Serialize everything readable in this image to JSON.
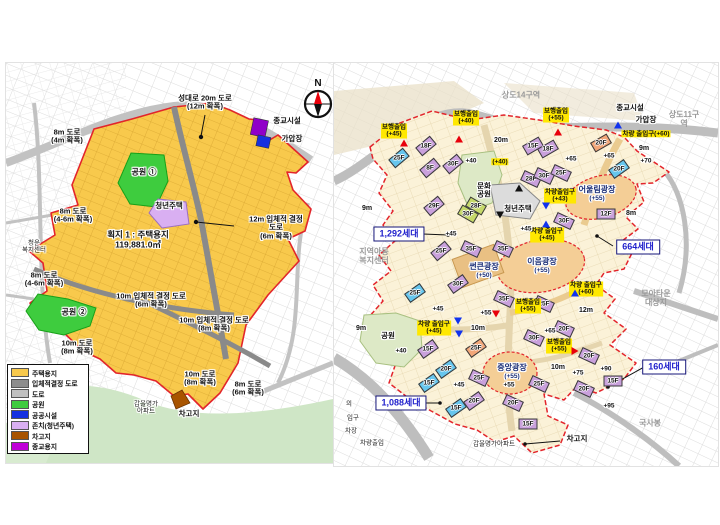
{
  "left_map": {
    "compass_label": "N",
    "site": {
      "name": "획지 1 : 주택용지",
      "area": "119,881.0㎡"
    },
    "legend": [
      {
        "label": "주택용지",
        "color": "#F8C94C"
      },
      {
        "label": "입체적결정 도로",
        "color": "#8C8C8C"
      },
      {
        "label": "도로",
        "color": "#C0C0C0"
      },
      {
        "label": "공원",
        "color": "#3ECC3E"
      },
      {
        "label": "공공시설",
        "color": "#1530E0"
      },
      {
        "label": "존치(청년주택)",
        "color": "#D9AFF2"
      },
      {
        "label": "차고지",
        "color": "#A85400"
      },
      {
        "label": "종교용지",
        "color": "#C000D8"
      }
    ],
    "labels": [
      {
        "t": "성대로 20m 도로\n(12m 확폭)",
        "x": 199,
        "y": 40,
        "k": "road"
      },
      {
        "t": "8m 도로\n(4m 확폭)",
        "x": 61,
        "y": 74,
        "k": "road"
      },
      {
        "t": "종교시설",
        "x": 281,
        "y": 58,
        "k": "feat"
      },
      {
        "t": "가압장",
        "x": 286,
        "y": 76,
        "k": "feat"
      },
      {
        "t": "공원 ①",
        "x": 138,
        "y": 110,
        "k": "park"
      },
      {
        "t": "청년주택",
        "x": 163,
        "y": 143,
        "k": "feat"
      },
      {
        "t": "12m 입체적 결정 도로\n(6m 확폭)",
        "x": 270,
        "y": 165,
        "k": "road"
      },
      {
        "t": "8m 도로\n(4-6m 확폭)",
        "x": 67,
        "y": 153,
        "k": "road"
      },
      {
        "t": "청운\n복지센터",
        "x": 28,
        "y": 184,
        "k": "small"
      },
      {
        "t": "획지 1 : 주택용지\n119,881.0㎡",
        "x": 132,
        "y": 177,
        "k": "site"
      },
      {
        "t": "8m 도로\n(4-6m 확폭)",
        "x": 38,
        "y": 217,
        "k": "road"
      },
      {
        "t": "공원 ②",
        "x": 68,
        "y": 250,
        "k": "park"
      },
      {
        "t": "10m 입체적 결정 도로\n(6m 확폭)",
        "x": 145,
        "y": 238,
        "k": "road"
      },
      {
        "t": "10m 입체적 결정 도로\n(8m 확폭)",
        "x": 208,
        "y": 262,
        "k": "road"
      },
      {
        "t": "10m 도로\n(8m 확폭)",
        "x": 71,
        "y": 285,
        "k": "road"
      },
      {
        "t": "10m 도로\n(8m 확폭)",
        "x": 194,
        "y": 316,
        "k": "road"
      },
      {
        "t": "8m 도로\n(6m 확폭)",
        "x": 242,
        "y": 326,
        "k": "road"
      },
      {
        "t": "갑을명가\n아파트",
        "x": 140,
        "y": 345,
        "k": "small"
      },
      {
        "t": "차고지",
        "x": 183,
        "y": 351,
        "k": "feat"
      }
    ]
  },
  "right_map": {
    "districts": [
      {
        "t": "상도14구역",
        "x": 187,
        "y": 33
      },
      {
        "t": "상도11구역",
        "x": 350,
        "y": 57
      },
      {
        "t": "모아타운\n대상지",
        "x": 322,
        "y": 236
      },
      {
        "t": "국사봉",
        "x": 316,
        "y": 361
      },
      {
        "t": "지역아동\n복지센터",
        "x": 40,
        "y": 194
      }
    ],
    "features": [
      {
        "t": "종교시설",
        "x": 296,
        "y": 45
      },
      {
        "t": "가압장",
        "x": 312,
        "y": 57
      },
      {
        "t": "차고지",
        "x": 243,
        "y": 376
      },
      {
        "t": "청년주택",
        "x": 184,
        "y": 146
      },
      {
        "t": "문화\n공원",
        "x": 150,
        "y": 128
      },
      {
        "t": "공원",
        "x": 54,
        "y": 273
      }
    ],
    "fragments": [
      {
        "t": "의",
        "x": 15,
        "y": 341
      },
      {
        "t": "입구",
        "x": 19,
        "y": 355
      },
      {
        "t": "차장",
        "x": 17,
        "y": 368
      },
      {
        "t": "차량출입",
        "x": 38,
        "y": 380
      },
      {
        "t": "갑을명가아파트",
        "x": 160,
        "y": 381
      }
    ],
    "places": [
      {
        "t": "어울림광장",
        "s": "(+55)",
        "x": 263,
        "y": 131
      },
      {
        "t": "이음광장",
        "s": "(+55)",
        "x": 208,
        "y": 203
      },
      {
        "t": "중앙광장",
        "s": "(+55)",
        "x": 178,
        "y": 309
      },
      {
        "t": "썬큰광장",
        "s": "(+50)",
        "x": 150,
        "y": 208
      }
    ],
    "access": [
      {
        "t": "보행출입\n(+45)",
        "x": 60,
        "y": 68
      },
      {
        "t": "보행출입\n(+40)",
        "x": 132,
        "y": 55
      },
      {
        "t": "보행출입\n(+55)",
        "x": 222,
        "y": 52
      },
      {
        "t": "차량 출입구(+60)",
        "x": 312,
        "y": 71
      },
      {
        "t": "(+40)",
        "x": 166,
        "y": 99
      },
      {
        "t": "차량출입구\n(+43)",
        "x": 226,
        "y": 133
      },
      {
        "t": "차량 출입구\n(+45)",
        "x": 213,
        "y": 172
      },
      {
        "t": "차량 출입구\n(+60)",
        "x": 252,
        "y": 226
      },
      {
        "t": "보행출입\n(+55)",
        "x": 194,
        "y": 243
      },
      {
        "t": "차량 출입구\n(+45)",
        "x": 100,
        "y": 265
      },
      {
        "t": "보행출입\n(+55)",
        "x": 225,
        "y": 283
      }
    ],
    "triangles": [
      {
        "x": 70,
        "y": 80,
        "d": "up",
        "c": "#e8000b"
      },
      {
        "x": 125,
        "y": 76,
        "d": "up",
        "c": "#e8000b"
      },
      {
        "x": 224,
        "y": 69,
        "d": "up",
        "c": "#e8000b"
      },
      {
        "x": 284,
        "y": 62,
        "d": "up",
        "c": "#1133ee"
      },
      {
        "x": 212,
        "y": 143,
        "d": "down",
        "c": "#1133ee"
      },
      {
        "x": 212,
        "y": 161,
        "d": "up",
        "c": "#1133ee"
      },
      {
        "x": 241,
        "y": 230,
        "d": "up",
        "c": "#1133ee"
      },
      {
        "x": 162,
        "y": 251,
        "d": "down",
        "c": "#e8000b"
      },
      {
        "x": 124,
        "y": 258,
        "d": "down",
        "c": "#1133ee"
      },
      {
        "x": 125,
        "y": 271,
        "d": "down",
        "c": "#1133ee"
      },
      {
        "x": 241,
        "y": 288,
        "d": "right",
        "c": "#e8000b"
      },
      {
        "x": 185,
        "y": 125,
        "d": "up",
        "c": "#111111"
      },
      {
        "x": 166,
        "y": 152,
        "d": "down",
        "c": "#111111"
      }
    ],
    "elevations": [
      {
        "t": "+40",
        "x": 137,
        "y": 98
      },
      {
        "t": "+45",
        "x": 117,
        "y": 171
      },
      {
        "t": "+45",
        "x": 192,
        "y": 166
      },
      {
        "t": "+45",
        "x": 104,
        "y": 246
      },
      {
        "t": "+45",
        "x": 125,
        "y": 322
      },
      {
        "t": "+55",
        "x": 152,
        "y": 250
      },
      {
        "t": "+55",
        "x": 175,
        "y": 322
      },
      {
        "t": "+65",
        "x": 237,
        "y": 96
      },
      {
        "t": "+65",
        "x": 275,
        "y": 93
      },
      {
        "t": "+65",
        "x": 216,
        "y": 268
      },
      {
        "t": "+70",
        "x": 312,
        "y": 98
      },
      {
        "t": "+75",
        "x": 244,
        "y": 310
      },
      {
        "t": "+90",
        "x": 272,
        "y": 306
      },
      {
        "t": "+95",
        "x": 275,
        "y": 343
      },
      {
        "t": "+40",
        "x": 67,
        "y": 288
      }
    ],
    "road_widths": [
      {
        "t": "20m",
        "x": 167,
        "y": 78
      },
      {
        "t": "9m",
        "x": 310,
        "y": 86
      },
      {
        "t": "8m",
        "x": 297,
        "y": 151
      },
      {
        "t": "9m",
        "x": 33,
        "y": 146
      },
      {
        "t": "9m",
        "x": 27,
        "y": 266
      },
      {
        "t": "10m",
        "x": 144,
        "y": 266
      },
      {
        "t": "10m",
        "x": 224,
        "y": 305
      },
      {
        "t": "12m",
        "x": 252,
        "y": 248
      }
    ],
    "units": [
      {
        "t": "1,292세대",
        "x": 65,
        "y": 171
      },
      {
        "t": "664세대",
        "x": 304,
        "y": 184
      },
      {
        "t": "160세대",
        "x": 330,
        "y": 304
      },
      {
        "t": "1,088세대",
        "x": 67,
        "y": 340
      }
    ],
    "building_colors": {
      "p": "#C9A0DC",
      "c": "#66C6EE",
      "o": "#F2A678",
      "g": "#C6D96A"
    },
    "buildings": [
      {
        "x": 92,
        "y": 83,
        "f": "18F",
        "c": "p",
        "r": -40
      },
      {
        "x": 65,
        "y": 95,
        "f": "25F",
        "c": "c",
        "r": -40
      },
      {
        "x": 96,
        "y": 105,
        "f": "8F",
        "c": "p",
        "r": -40
      },
      {
        "x": 119,
        "y": 101,
        "f": "30F",
        "c": "p",
        "r": -40
      },
      {
        "x": 199,
        "y": 83,
        "f": "15F",
        "c": "p",
        "r": -30
      },
      {
        "x": 214,
        "y": 86,
        "f": "18F",
        "c": "p",
        "r": -30
      },
      {
        "x": 267,
        "y": 80,
        "f": "20F",
        "c": "o",
        "r": -30
      },
      {
        "x": 285,
        "y": 106,
        "f": "20F",
        "c": "c",
        "r": -35
      },
      {
        "x": 227,
        "y": 110,
        "f": "25F",
        "c": "p",
        "r": 25
      },
      {
        "x": 197,
        "y": 116,
        "f": "28F",
        "c": "p",
        "r": 25
      },
      {
        "x": 210,
        "y": 113,
        "f": "30F",
        "c": "p",
        "r": 25
      },
      {
        "x": 100,
        "y": 143,
        "f": "29F",
        "c": "p",
        "r": -40
      },
      {
        "x": 142,
        "y": 143,
        "f": "28F",
        "c": "g",
        "r": 30
      },
      {
        "x": 134,
        "y": 151,
        "f": "30F",
        "c": "g",
        "r": 30
      },
      {
        "x": 272,
        "y": 151,
        "f": "12F",
        "c": "p",
        "r": 0
      },
      {
        "x": 230,
        "y": 158,
        "f": "30F",
        "c": "p",
        "r": 25
      },
      {
        "x": 107,
        "y": 188,
        "f": "25F",
        "c": "p",
        "r": -40
      },
      {
        "x": 137,
        "y": 186,
        "f": "35F",
        "c": "p",
        "r": 25
      },
      {
        "x": 169,
        "y": 186,
        "f": "35F",
        "c": "p",
        "r": 25
      },
      {
        "x": 124,
        "y": 221,
        "f": "30F",
        "c": "p",
        "r": -35
      },
      {
        "x": 81,
        "y": 230,
        "f": "25F",
        "c": "c",
        "r": -35
      },
      {
        "x": 170,
        "y": 236,
        "f": "35F",
        "c": "p",
        "r": 25
      },
      {
        "x": 210,
        "y": 241,
        "f": "25F",
        "c": "p",
        "r": 25
      },
      {
        "x": 230,
        "y": 266,
        "f": "20F",
        "c": "p",
        "r": 25
      },
      {
        "x": 94,
        "y": 286,
        "f": "15F",
        "c": "p",
        "r": -35
      },
      {
        "x": 142,
        "y": 285,
        "f": "25F",
        "c": "o",
        "r": -35
      },
      {
        "x": 200,
        "y": 275,
        "f": "30F",
        "c": "p",
        "r": 25
      },
      {
        "x": 112,
        "y": 306,
        "f": "20F",
        "c": "c",
        "r": -35
      },
      {
        "x": 95,
        "y": 320,
        "f": "15F",
        "c": "c",
        "r": -35
      },
      {
        "x": 145,
        "y": 315,
        "f": "25F",
        "c": "p",
        "r": 25
      },
      {
        "x": 205,
        "y": 321,
        "f": "25F",
        "c": "p",
        "r": 25
      },
      {
        "x": 140,
        "y": 338,
        "f": "20F",
        "c": "p",
        "r": -35
      },
      {
        "x": 179,
        "y": 340,
        "f": "20F",
        "c": "p",
        "r": 25
      },
      {
        "x": 122,
        "y": 345,
        "f": "15F",
        "c": "c",
        "r": -35
      },
      {
        "x": 194,
        "y": 361,
        "f": "15F",
        "c": "p",
        "r": 0
      },
      {
        "x": 255,
        "y": 293,
        "f": "20F",
        "c": "p",
        "r": 25
      },
      {
        "x": 250,
        "y": 326,
        "f": "20F",
        "c": "p",
        "r": 25
      },
      {
        "x": 279,
        "y": 318,
        "f": "15F",
        "c": "p",
        "r": 0
      }
    ]
  }
}
